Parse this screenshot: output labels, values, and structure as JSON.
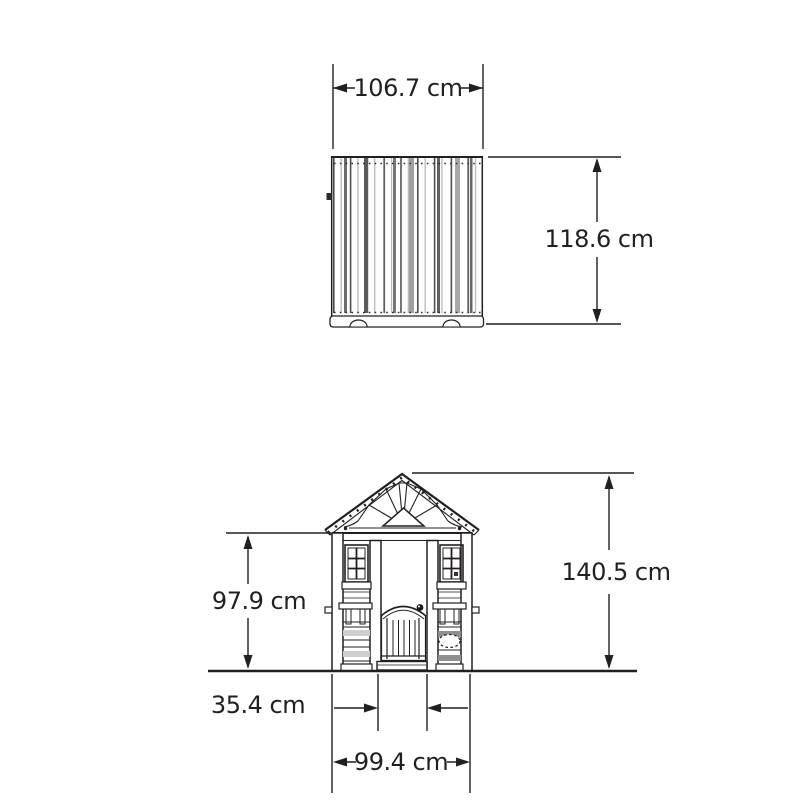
{
  "diagram": {
    "unit": "cm",
    "background": "#ffffff",
    "stroke_color": "#231f20",
    "views": {
      "top_view": {
        "title": "roof top view"
      },
      "front_view": {
        "title": "playhouse front elevation"
      }
    },
    "dimensions": {
      "roof_width": {
        "label": "106.7 cm",
        "value": 106.7,
        "unit": "cm",
        "view": "top_view"
      },
      "roof_depth": {
        "label": "118.6 cm",
        "value": 118.6,
        "unit": "cm",
        "view": "top_view"
      },
      "wall_height": {
        "label": "97.9 cm",
        "value": 97.9,
        "unit": "cm",
        "view": "front_view"
      },
      "overall_height": {
        "label": "140.5 cm",
        "value": 140.5,
        "unit": "cm",
        "view": "front_view"
      },
      "side_panel_width": {
        "label": "35.4 cm",
        "value": 35.4,
        "unit": "cm",
        "view": "front_view"
      },
      "base_width": {
        "label": "99.4 cm",
        "value": 99.4,
        "unit": "cm",
        "view": "front_view"
      }
    }
  }
}
